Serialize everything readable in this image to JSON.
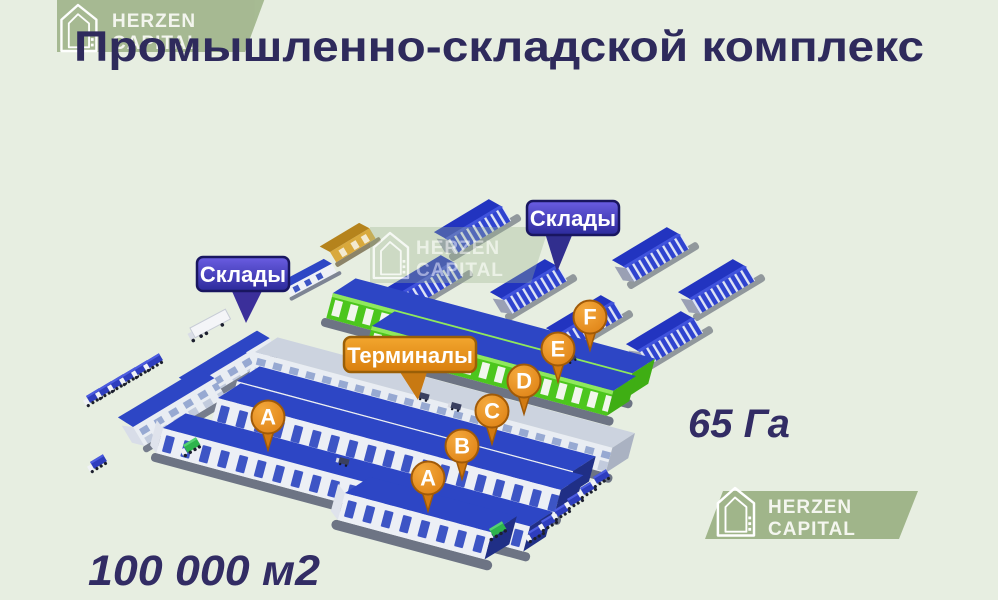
{
  "title": "Промышленно-складской комплекс",
  "watermark": {
    "line1": "HERZEN",
    "line2": "CAPITAL"
  },
  "labels": {
    "warehouses_left": "Склады",
    "warehouses_top": "Склады",
    "terminals": "Терминалы"
  },
  "stats": {
    "land_area": "65 Га",
    "built_area": "100 000 м2"
  },
  "pins": [
    {
      "letter": "A",
      "x": 268,
      "y": 417
    },
    {
      "letter": "A",
      "x": 428,
      "y": 478
    },
    {
      "letter": "B",
      "x": 462,
      "y": 446
    },
    {
      "letter": "C",
      "x": 492,
      "y": 411
    },
    {
      "letter": "D",
      "x": 524,
      "y": 381
    },
    {
      "letter": "E",
      "x": 558,
      "y": 349
    },
    {
      "letter": "F",
      "x": 590,
      "y": 317
    }
  ],
  "colors": {
    "background": "#e7eee1",
    "title_navy": "#2e2a5c",
    "badge_purple": "#3b34ad",
    "badge_orange": "#e8941c",
    "pin_orange": "#e1851a",
    "building_blue": "#2d46c5",
    "building_green": "#4cc61d",
    "watermark_sage": "#a0b58a"
  }
}
